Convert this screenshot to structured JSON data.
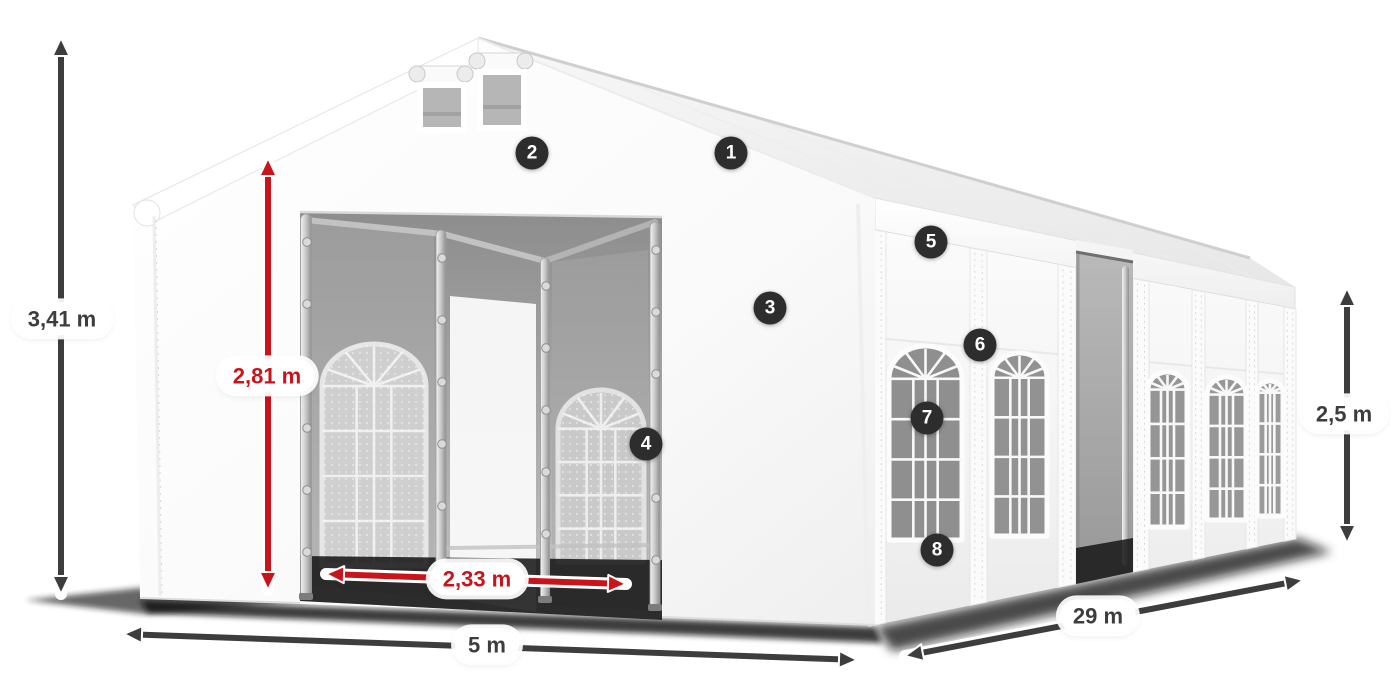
{
  "dimensions": [
    {
      "id": "total-height",
      "label": "3,41 m",
      "color": "dark"
    },
    {
      "id": "entrance-clear-height",
      "label": "2,81 m",
      "color": "red"
    },
    {
      "id": "entrance-width",
      "label": "2,33 m",
      "color": "red"
    },
    {
      "id": "gable-width",
      "label": "5 m",
      "color": "dark"
    },
    {
      "id": "length",
      "label": "29 m",
      "color": "dark"
    },
    {
      "id": "side-wall-height",
      "label": "2,5 m",
      "color": "dark"
    }
  ],
  "callouts": [
    {
      "number": "1"
    },
    {
      "number": "2"
    },
    {
      "number": "3"
    },
    {
      "number": "4"
    },
    {
      "number": "5"
    },
    {
      "number": "6"
    },
    {
      "number": "7"
    },
    {
      "number": "8"
    }
  ],
  "colors": {
    "dimension_dark": "#3d3d3d",
    "dimension_red": "#c8141a",
    "badge_background": "#2d2d2d",
    "badge_text": "#ffffff"
  }
}
